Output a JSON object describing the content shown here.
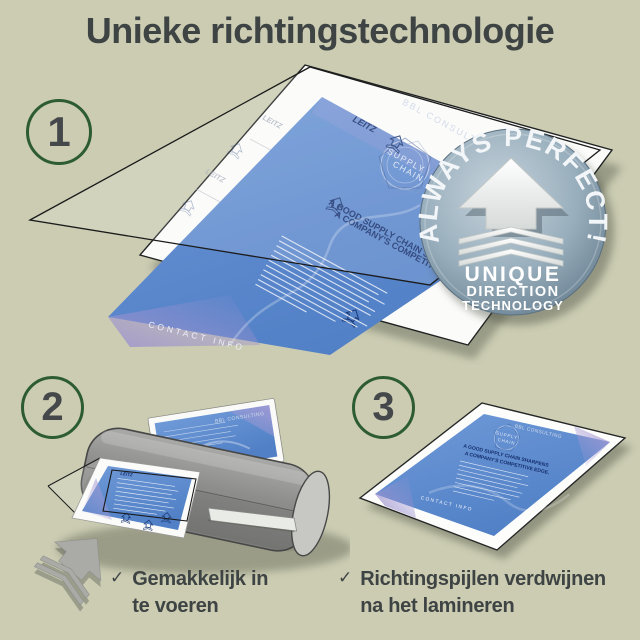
{
  "title": "Unieke richtingstechnologie",
  "steps": {
    "one": "1",
    "two": "2",
    "three": "3"
  },
  "badge": {
    "arc": "ALWAYS PERFECT!",
    "line1": "UNIQUE",
    "line2": "DIRECTION",
    "line3": "TECHNOLOGY"
  },
  "doc": {
    "brand": "LEITZ",
    "consulting": "BBL CONSULTING",
    "emblem1": "SUPPLY",
    "emblem2": "CHAIN",
    "heading1": "A GOOD SUPPLY CHAIN SHARPENS",
    "heading2": "A COMPANY'S COMPETITIVE EDGE.",
    "footer": "CONTACT INFO"
  },
  "checklist": {
    "item1": {
      "check": "✓",
      "line1": "Gemakkelijk in",
      "line2": "te voeren"
    },
    "item2": {
      "check": "✓",
      "line1": "Richtingspijlen verdwijnen",
      "line2": "na het lamineren"
    }
  },
  "colors": {
    "background": "#cbccb2",
    "text": "#3e4343",
    "circle_green": "#2d5c33",
    "document_blue": "#6392cf",
    "accent_purple": "#9d92cf",
    "badge_gray_blue": "#8ba1b1",
    "machine_gray": "#8f908e",
    "navy": "#1d3a78"
  }
}
